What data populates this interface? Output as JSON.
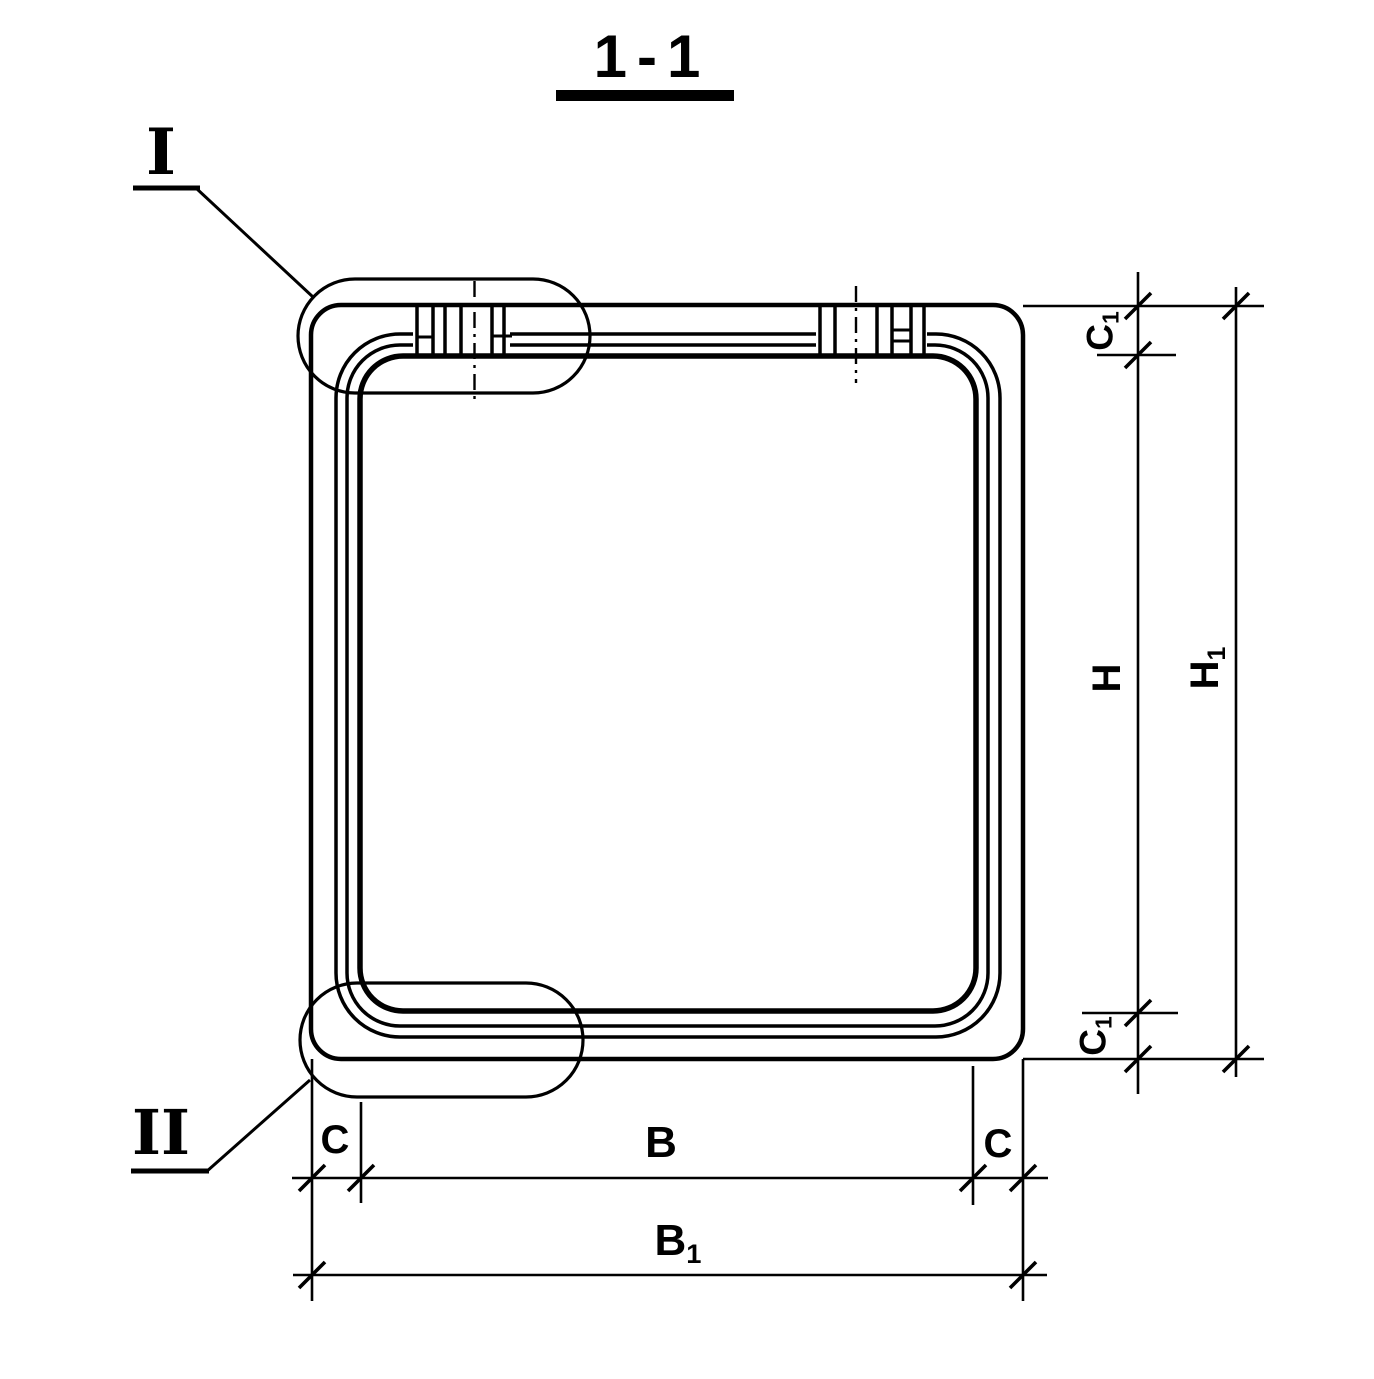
{
  "title": {
    "text": "1-1"
  },
  "callouts": {
    "detail_1": "I",
    "detail_2": "II"
  },
  "dimensions": {
    "c1_top": {
      "base": "C",
      "sub": "1"
    },
    "h": {
      "base": "H",
      "sub": ""
    },
    "h1": {
      "base": "H",
      "sub": "1"
    },
    "c1_bottom": {
      "base": "C",
      "sub": "1"
    },
    "c_left": {
      "base": "C",
      "sub": ""
    },
    "b": {
      "base": "B",
      "sub": ""
    },
    "c_right": {
      "base": "C",
      "sub": ""
    },
    "b1": {
      "base": "B",
      "sub": "1"
    }
  },
  "colors": {
    "ink": "#000000",
    "paper": "#ffffff"
  }
}
